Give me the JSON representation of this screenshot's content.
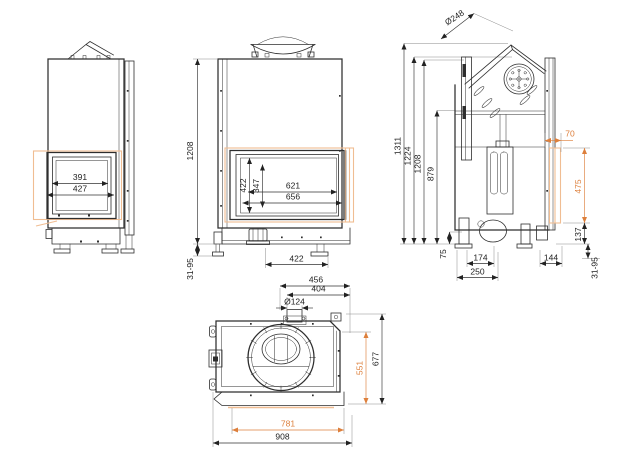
{
  "meta": {
    "type": "technical-drawing",
    "subject": "fireplace-insert-dimension-drawing"
  },
  "colors": {
    "line": "#2e2e2e",
    "dim": "#333333",
    "accent": "#dd7f3b",
    "accent_light": "#f0bd92"
  },
  "views": {
    "side_left": {
      "label": "left-side-view",
      "dims": {
        "glass_width": "391",
        "door_width": "427"
      }
    },
    "front": {
      "label": "front-view",
      "dims": {
        "height_total": "1208",
        "foot_range": "31-95",
        "glass_height": "422",
        "opening_height": "347",
        "glass_width": "621",
        "door_width": "656",
        "base_width": "422"
      }
    },
    "side_right": {
      "label": "right-side-view",
      "dims": {
        "flue_diameter": "Ø248",
        "height_flue_top": "1311",
        "height_top_edge": "1224",
        "height_body": "1208",
        "height_mid": "879",
        "height_base_gap": "75",
        "base_depth_front": "174",
        "base_depth": "250",
        "side_glass_offset": "70",
        "side_glass_height": "475",
        "side_lower": "137",
        "rear_depth": "144",
        "foot_range": "31-95"
      }
    },
    "top": {
      "label": "top-view",
      "dims": {
        "width_inner": "456",
        "width_frame": "404",
        "spigot_diameter": "Ø124",
        "glass_depth": "551",
        "depth_total": "677",
        "front_width": "781",
        "width_total": "908"
      }
    }
  }
}
